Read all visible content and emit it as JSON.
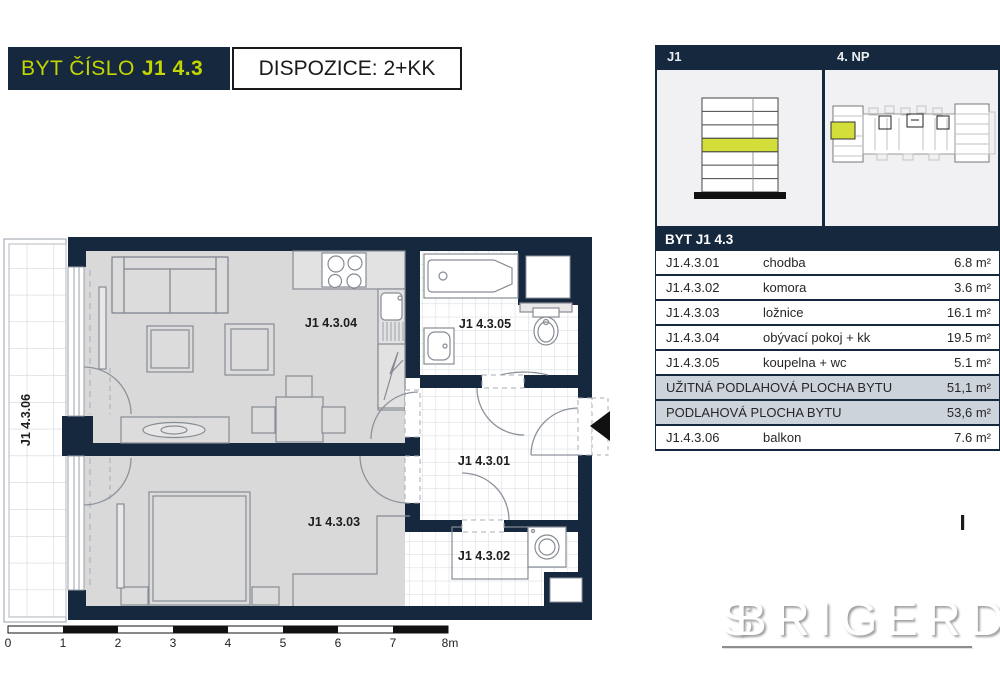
{
  "colors": {
    "navy": "#15283e",
    "accent": "#c4d600",
    "summary_bg": "#ccd3da",
    "floor_gray": "#d9d9d9"
  },
  "header": {
    "title_prefix": "BYT ČÍSLO",
    "title_unit": "J1 4.3",
    "dispozice": "DISPOZICE: 2+KK"
  },
  "panel": {
    "building": "J1",
    "floor": "4. NP",
    "unit": "BYT J1 4.3",
    "rows": [
      {
        "code": "J1.4.3.01",
        "name": "chodba",
        "area": "6.8 m²"
      },
      {
        "code": "J1.4.3.02",
        "name": "komora",
        "area": "3.6 m²"
      },
      {
        "code": "J1.4.3.03",
        "name": "ložnice",
        "area": "16.1 m²"
      },
      {
        "code": "J1.4.3.04",
        "name": "obývací pokoj + kk",
        "area": "19.5 m²"
      },
      {
        "code": "J1.4.3.05",
        "name": "koupelna + wc",
        "area": "5.1 m²"
      }
    ],
    "summary_rows": [
      {
        "label": "UŽITNÁ PODLAHOVÁ PLOCHA BYTU",
        "area": "51,1 m²"
      },
      {
        "label": "PODLAHOVÁ PLOCHA BYTU",
        "area": "53,6 m²"
      }
    ],
    "balcony_row": {
      "code": "J1.4.3.06",
      "name": "balkon",
      "area": "7.6 m²"
    }
  },
  "plan": {
    "labels": {
      "living": "J1 4.3.04",
      "bathroom": "J1 4.3.05",
      "hall": "J1 4.3.01",
      "bedroom": "J1 4.3.03",
      "storage": "J1 4.3.02",
      "balcony": "J1 4.3.06"
    },
    "scale_ticks": [
      "0",
      "1",
      "2",
      "3",
      "4",
      "5",
      "6",
      "7",
      "8m"
    ]
  },
  "logo": {
    "monogram_s": "S",
    "monogram_b": "B",
    "text": "RIGERD"
  }
}
